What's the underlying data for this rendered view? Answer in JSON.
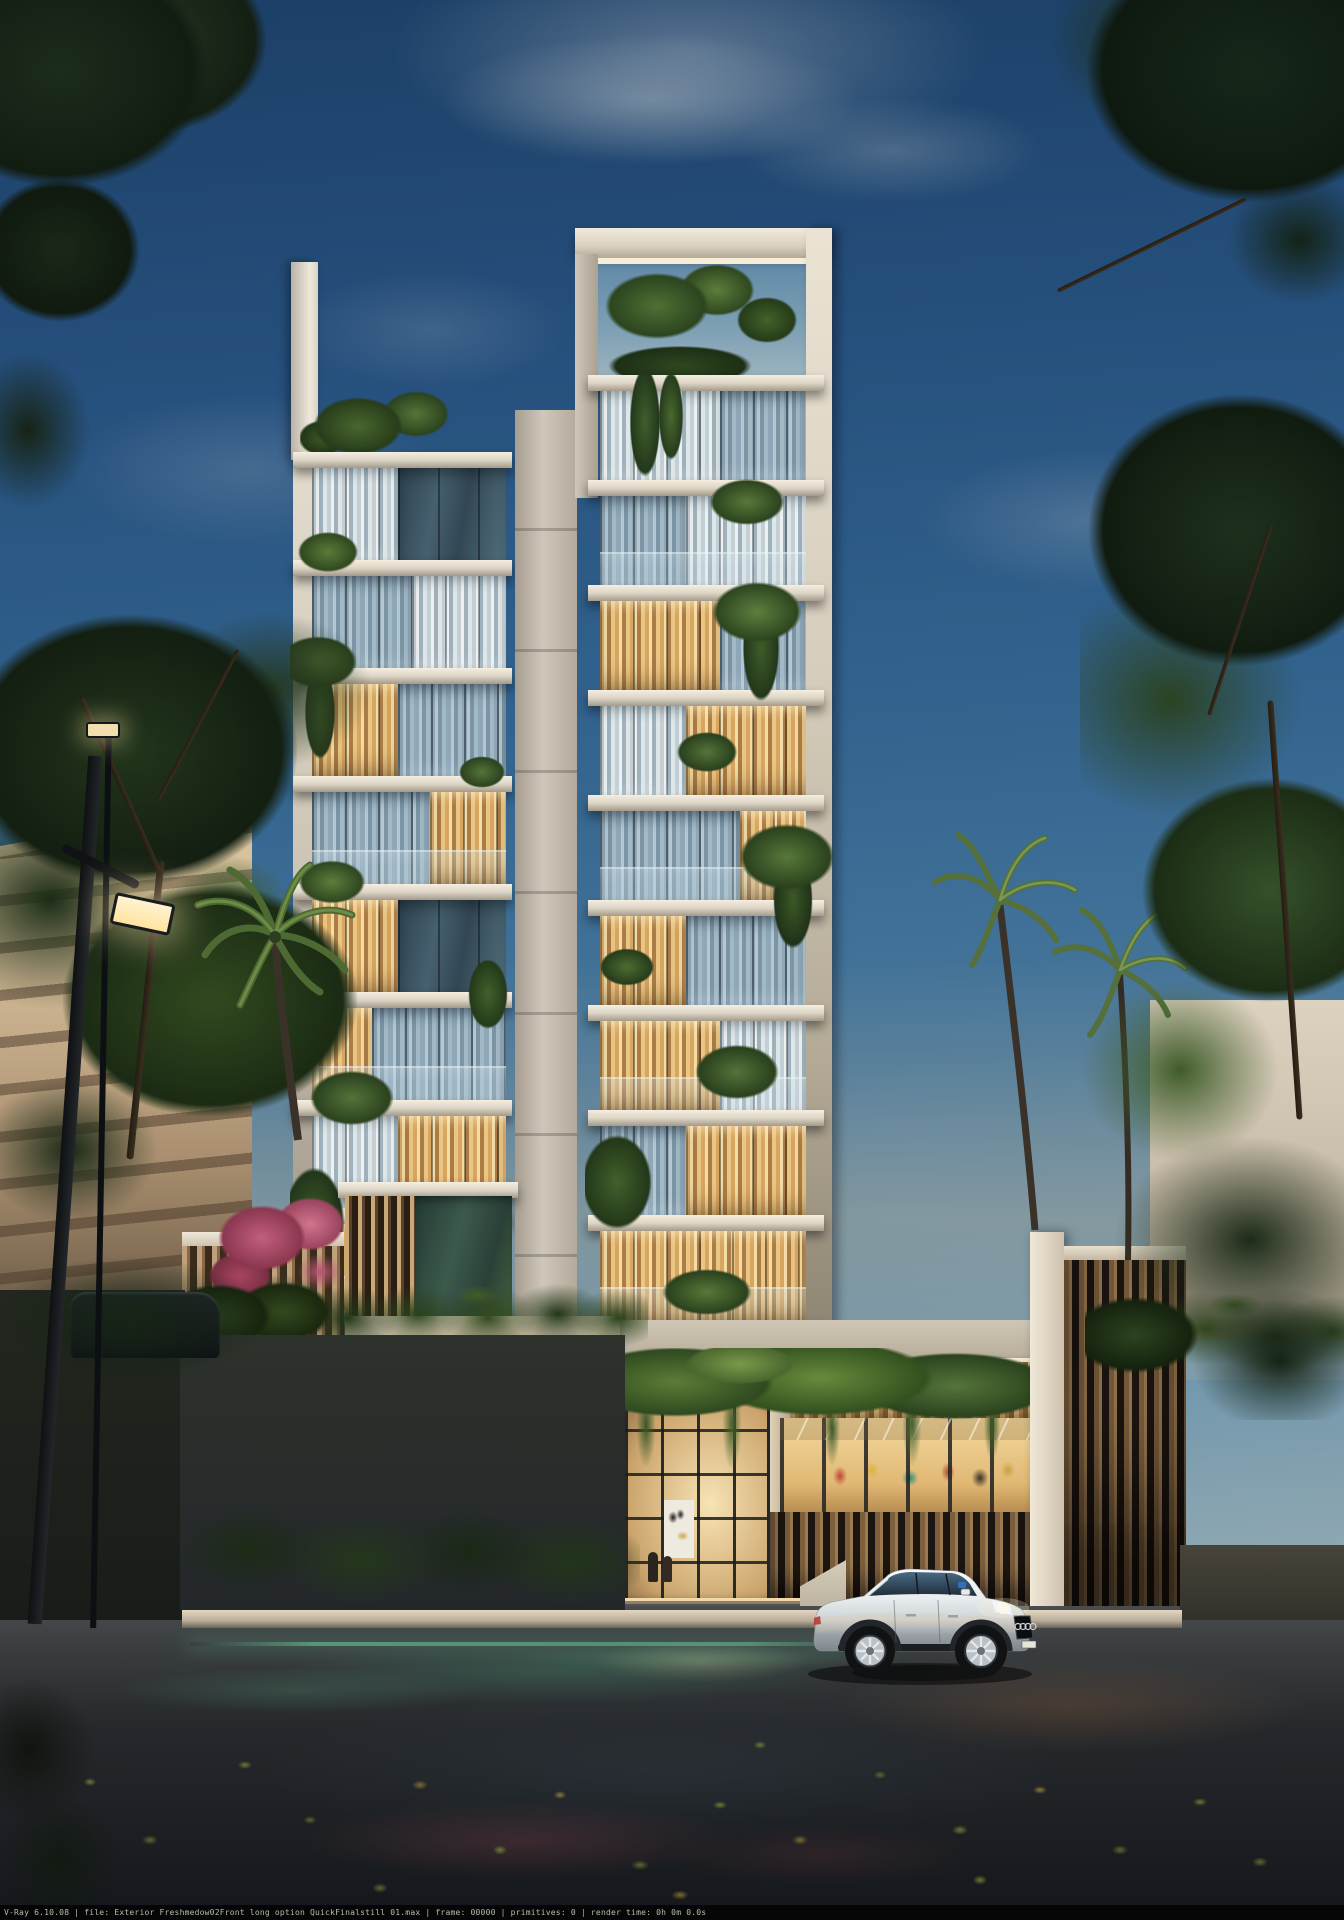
{
  "render_stamp": {
    "text": "V-Ray 6.10.08 | file: Exterior Freshmedow02Front long option QuickFinalstill 01.max | frame: 00000 | primitives: 0 | render time:  0h  0m  0.0s"
  },
  "scene": {
    "description": "Dusk exterior architectural rendering of a slender ten-storey white residential tower with planted balconies, double-height glass lobby, white estate car at the kerb, street lamps, palms and dense trees",
    "palette": {
      "sky_top": "#1c3f66",
      "sky_horizon": "#c8bfa8",
      "facade_white": "#e9e2d4",
      "curtain_warm": "#e8c27f",
      "glass_cool": "#93adbd",
      "foliage_dark": "#24371f",
      "foliage_light": "#64823c",
      "asphalt": "#1f2428",
      "interior_glow": "#f2d9a8",
      "car_body": "#e8eaec",
      "bougainvillea": "#b04a66"
    },
    "objects": [
      "residential-tower",
      "glass-lobby",
      "white-estate-car",
      "street-lamps",
      "palm-trees",
      "hedges-and-fences",
      "street-foreground"
    ]
  }
}
